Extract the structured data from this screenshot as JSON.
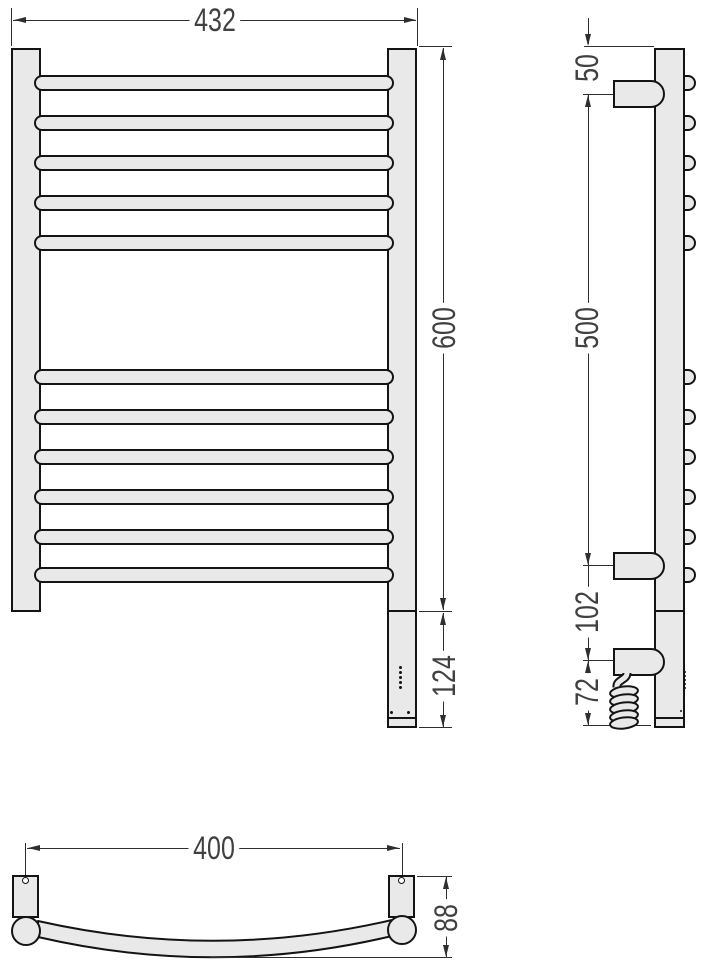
{
  "drawing_type": "towel-radiator-dimension-drawing",
  "colors": {
    "part_fill": "#e9e9e9",
    "outline": "#141414",
    "dimension_line": "#2f2f2f",
    "dimension_text": "#404040",
    "background": "#ffffff"
  },
  "views": {
    "front": {
      "labels": {
        "overall_width": "432",
        "rail_height": "600",
        "heater_section": "124"
      }
    },
    "side": {
      "labels": {
        "bracket_top_offset": "50",
        "bracket_spacing": "500",
        "heater_offset": "102",
        "cable_length": "72"
      }
    },
    "top": {
      "labels": {
        "mount_spacing": "400",
        "depth": "88"
      }
    }
  }
}
